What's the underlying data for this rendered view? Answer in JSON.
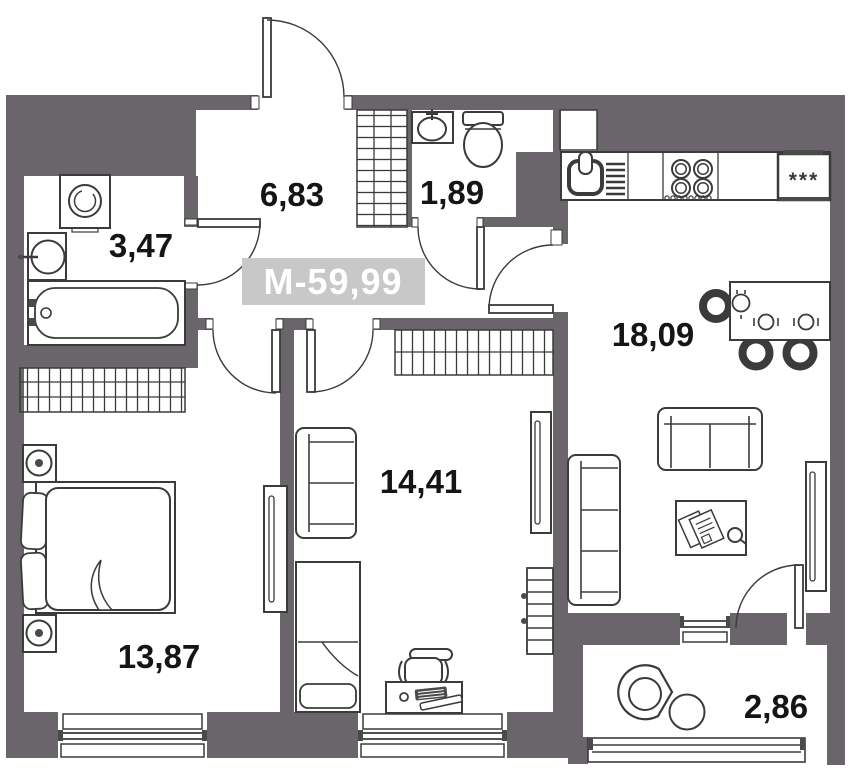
{
  "unit_badge": {
    "label": "М-59,99",
    "total_area": "59,99"
  },
  "rooms": [
    {
      "name": "hallway",
      "area_label": "6,83"
    },
    {
      "name": "wc",
      "area_label": "1,89"
    },
    {
      "name": "bathroom",
      "area_label": "3,47"
    },
    {
      "name": "kitchen-living-room",
      "area_label": "18,09"
    },
    {
      "name": "room",
      "area_label": "14,41"
    },
    {
      "name": "bedroom",
      "area_label": "13,87"
    },
    {
      "name": "balcony",
      "area_label": "2,86"
    }
  ],
  "appliances": {
    "fridge_label": "***"
  },
  "icons": [
    "washing-machine-icon",
    "sink-icon",
    "bathtub-icon",
    "toilet-icon",
    "stove-icon",
    "fridge-icon",
    "dining-table-icon",
    "chair-icon",
    "sofa-icon",
    "coffee-table-icon",
    "tv-icon",
    "bed-icon",
    "desk-icon",
    "radiator-icon",
    "lounge-chair-icon",
    "wardrobe-hatch-icon",
    "door-swing-icon",
    "window-icon"
  ],
  "colors": {
    "wall": "#69656a",
    "line": "#3b3b3b",
    "dark": "#4a4a4a",
    "text": "#151515",
    "badge_bg": "#c8c8c8",
    "badge_text": "#ffffff"
  }
}
